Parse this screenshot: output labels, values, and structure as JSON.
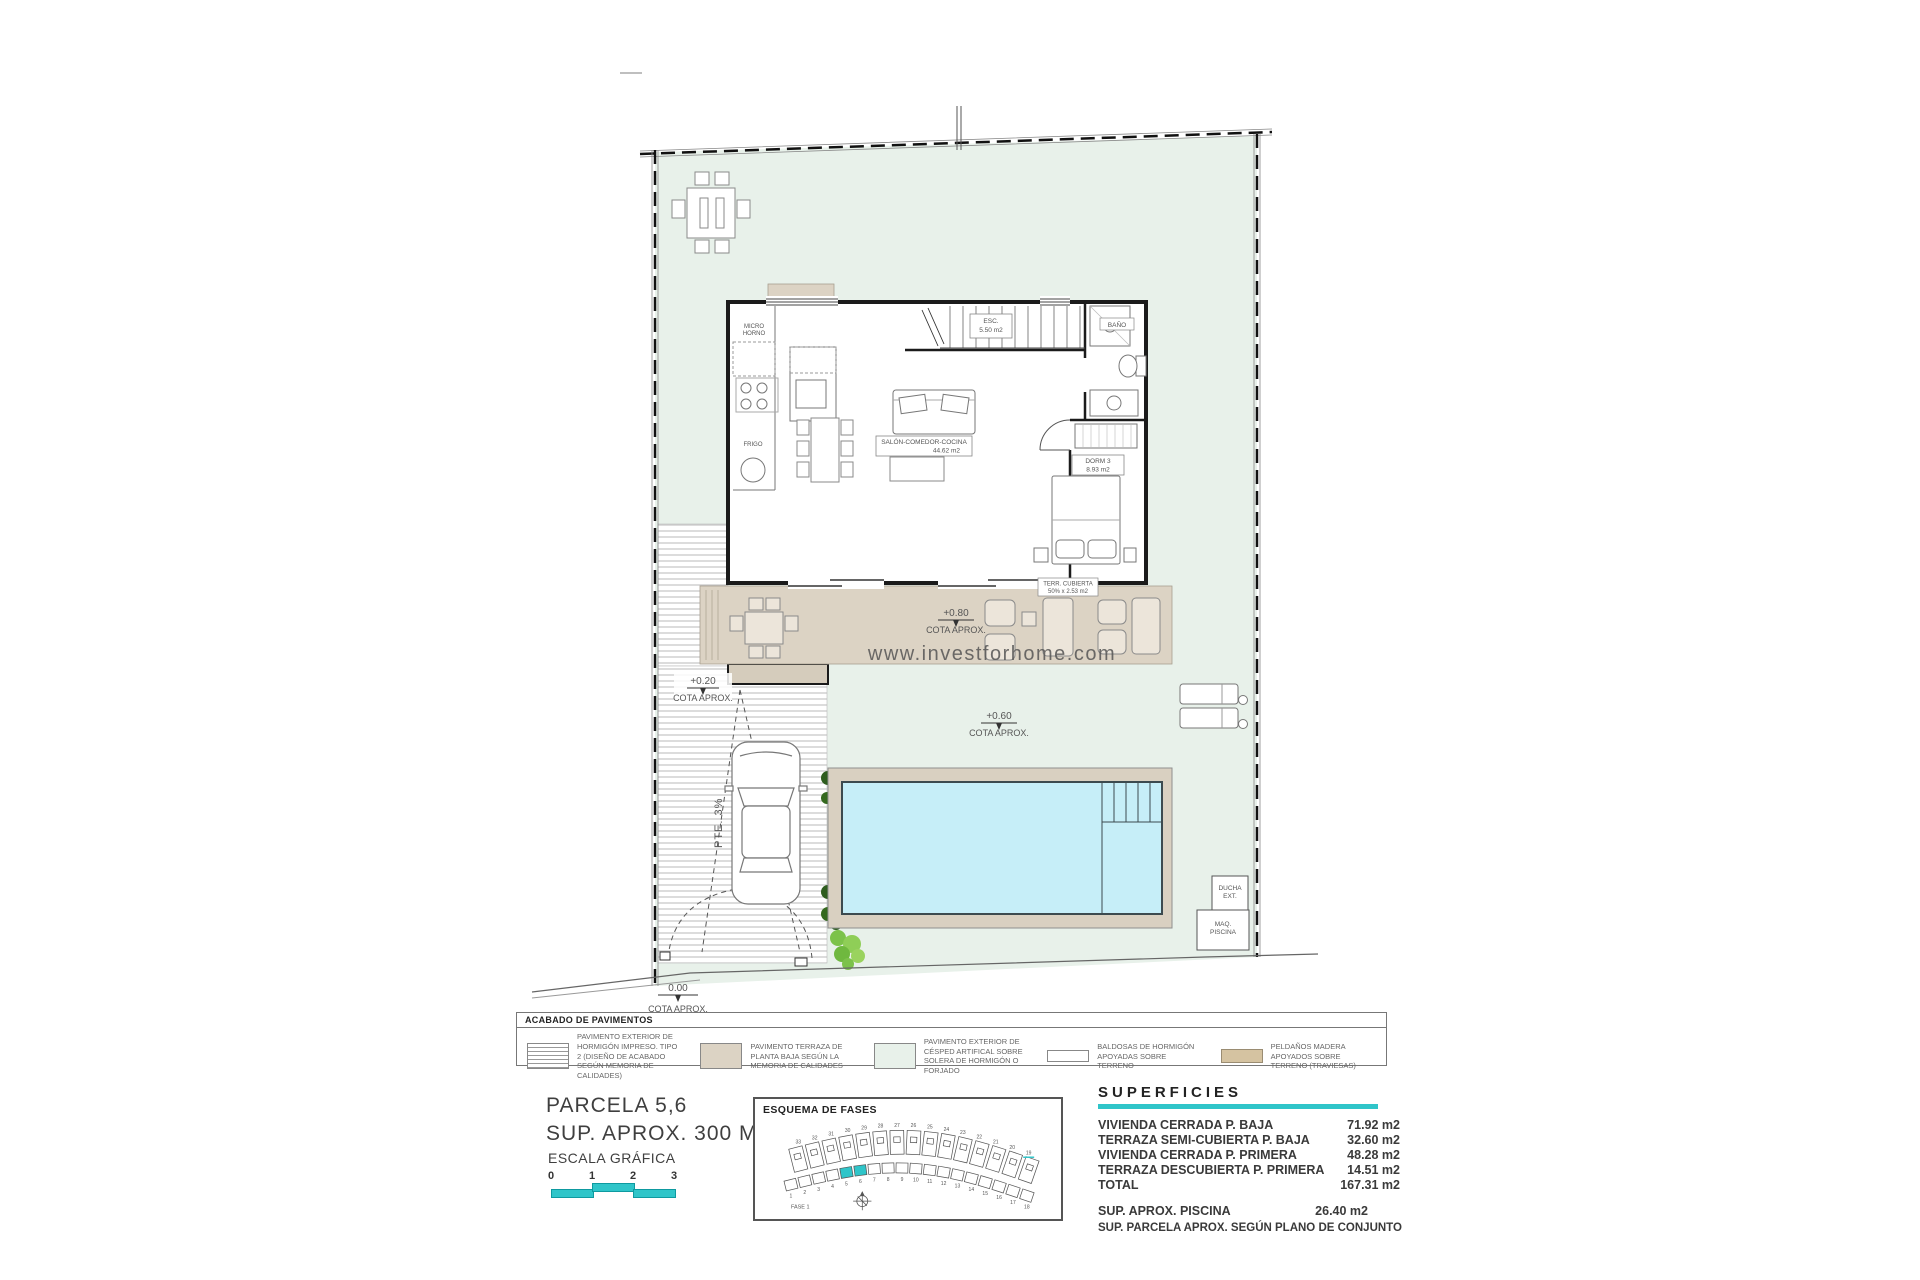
{
  "colors": {
    "teal": "#2fc5c9",
    "lawn": "#e8f1ea",
    "terrace": "#dcd3c4",
    "pool": "#c6eef8",
    "deck": "#d9d0c1",
    "wood": "#d5c3a1"
  },
  "watermark": "www.investforhome.com",
  "plan": {
    "labels": {
      "salon_l1": "SALÓN-COMEDOR-COCINA",
      "salon_l2": "44.62 m2",
      "dorm_l1": "DORM 3",
      "dorm_l2": "8.93 m2",
      "esc_l1": "ESC.",
      "esc_l2": "5.50 m2",
      "bano": "BAÑO",
      "terr_l1": "TERR. CUBIERTA",
      "terr_l2": "50% x 2.53 m2",
      "micro_l1": "MICRO",
      "micro_l2": "HORNO",
      "frigo": "FRIGO",
      "pte": "PTE. 3%",
      "ducha_l1": "DUCHA",
      "ducha_l2": "EXT.",
      "maq_l1": "MAQ.",
      "maq_l2": "PISCINA",
      "cota080": "+0.80",
      "cota020": "+0.20",
      "cota060": "+0.60",
      "cota000": "0.00",
      "cota_caption": "COTA APROX."
    }
  },
  "legend": {
    "title": "ACABADO DE PAVIMENTOS",
    "items": [
      {
        "swatch": "hatch",
        "text": "PAVIMENTO EXTERIOR DE HORMIGÓN IMPRESO. TIPO 2 (DISEÑO DE ACABADO SEGÚN MEMORIA DE CALIDADES)"
      },
      {
        "swatch": "terrace",
        "text": "PAVIMENTO TERRAZA DE PLANTA BAJA SEGÚN LA MEMORIA DE CALIDADES"
      },
      {
        "swatch": "grass",
        "text": "PAVIMENTO EXTERIOR DE CÉSPED ARTIFICAL SOBRE SOLERA DE HORMIGÓN O FORJADO"
      },
      {
        "swatch": "tile",
        "text": "BALDOSAS DE HORMIGÓN APOYADAS SOBRE TERRENO"
      },
      {
        "swatch": "wood",
        "text": "PELDAÑOS MADERA APOYADOS SOBRE TERRENO (TRAVIESAS)"
      }
    ]
  },
  "info": {
    "parcela_l1": "PARCELA 5,6",
    "parcela_l2": "SUP. APROX. 300 M2",
    "escala": "ESCALA GRÁFICA",
    "scale_ticks": [
      "0",
      "1",
      "2",
      "3"
    ]
  },
  "fases": {
    "title": "ESQUEMA DE FASES",
    "fase": "FASE 1",
    "top_row": [
      "33",
      "32",
      "31",
      "30",
      "29",
      "28",
      "27",
      "26",
      "25",
      "24",
      "23",
      "22",
      "21",
      "20",
      "19"
    ],
    "bottom_row": [
      "1",
      "2",
      "3",
      "4",
      "5",
      "6",
      "7",
      "8",
      "9",
      "10",
      "11",
      "12",
      "13",
      "14",
      "15",
      "16",
      "17",
      "18"
    ],
    "highlight": [
      "5",
      "6"
    ]
  },
  "superficies": {
    "title": "SUPERFICIES",
    "rows": [
      {
        "label": "VIVIENDA CERRADA P. BAJA",
        "value": "71.92 m2"
      },
      {
        "label": "TERRAZA SEMI-CUBIERTA P. BAJA",
        "value": "32.60 m2"
      },
      {
        "label": "VIVIENDA CERRADA P. PRIMERA",
        "value": "48.28 m2"
      },
      {
        "label": "TERRAZA DESCUBIERTA P. PRIMERA",
        "value": "14.51 m2"
      },
      {
        "label": "TOTAL",
        "value": "167.31 m2"
      }
    ],
    "piscina": {
      "label": "SUP. APROX. PISCINA",
      "value": "26.40 m2"
    },
    "footnote": "SUP. PARCELA APROX. SEGÚN PLANO DE CONJUNTO"
  }
}
